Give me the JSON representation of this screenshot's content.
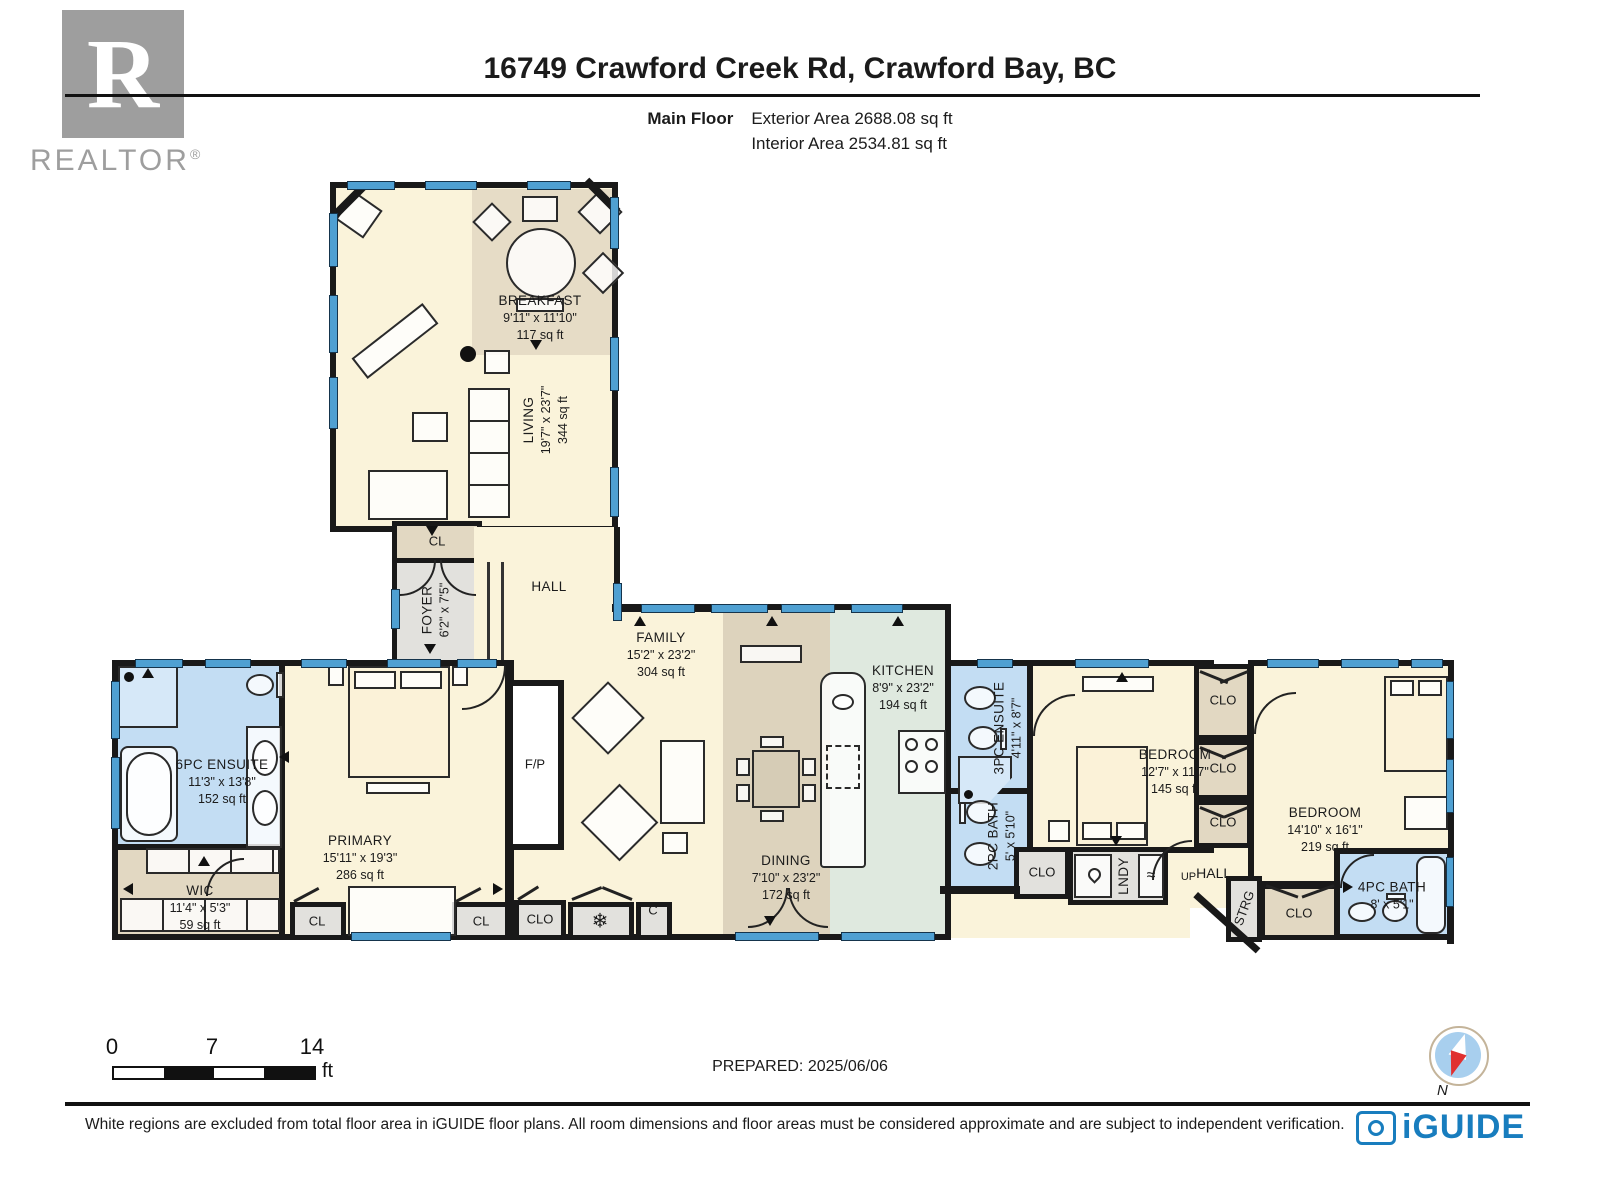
{
  "header": {
    "logo_r": "R",
    "realtor": "REALTOR",
    "registered": "®",
    "title": "16749 Crawford Creek Rd, Crawford Bay, BC",
    "floor_label": "Main Floor",
    "exterior_area": "Exterior Area 2688.08 sq ft",
    "interior_area": "Interior Area 2534.81 sq ft"
  },
  "rooms": {
    "breakfast": {
      "name": "BREAKFAST",
      "dims": "9'11\" x 11'10\"",
      "area": "117 sq ft"
    },
    "living": {
      "name": "LIVING",
      "dims": "19'7\" x 23'7\"",
      "area": "344 sq ft"
    },
    "foyer": {
      "name": "FOYER",
      "dims": "6'2\" x 7'5\""
    },
    "hall": {
      "name": "HALL"
    },
    "family": {
      "name": "FAMILY",
      "dims": "15'2\" x 23'2\"",
      "area": "304 sq ft"
    },
    "kitchen": {
      "name": "KITCHEN",
      "dims": "8'9\" x 23'2\"",
      "area": "194 sq ft"
    },
    "ensuite6": {
      "name": "6PC ENSUITE",
      "dims": "11'3\" x 13'8\"",
      "area": "152 sq ft"
    },
    "wic": {
      "name": "WIC",
      "dims": "11'4\" x 5'3\"",
      "area": "59 sq ft"
    },
    "primary": {
      "name": "PRIMARY",
      "dims": "15'11\" x 19'3\"",
      "area": "286 sq ft"
    },
    "dining": {
      "name": "DINING",
      "dims": "7'10\" x 23'2\"",
      "area": "172 sq ft"
    },
    "ensuite3": {
      "name": "3PC ENSUITE",
      "dims": "4'11\" x 8'7\""
    },
    "bath2": {
      "name": "2PC BATH",
      "dims": "5' x 5'10\""
    },
    "bedroom1": {
      "name": "BEDROOM",
      "dims": "12'7\" x 11'7\"",
      "area": "145 sq ft"
    },
    "bedroom2": {
      "name": "BEDROOM",
      "dims": "14'10\" x 16'1\"",
      "area": "219 sq ft"
    },
    "bath4": {
      "name": "4PC BATH",
      "dims": "8' x 5'1\""
    }
  },
  "labels": {
    "cl": "CL",
    "clo": "CLO",
    "c": "C",
    "fp": "F/P",
    "lndy": "LNDY",
    "up": "UP",
    "hall": "HALL",
    "strg": "STRG",
    "north": "N"
  },
  "icons": {
    "freezer": "❄",
    "dryer": "≈"
  },
  "scalebar": {
    "n0": "0",
    "n7": "7",
    "n14": "14",
    "unit": "ft"
  },
  "footer": {
    "prepared": "PREPARED: 2025/06/06",
    "disclaimer": "White regions are excluded from total floor area in iGUIDE floor plans. All room dimensions and floor areas must be considered approximate and are subject to independent verification.",
    "brand": "iGUIDE"
  },
  "colors": {
    "cream": "#FAF3DA",
    "tan": "#E2D8C2",
    "bath_blue": "#C3DDF3",
    "mint": "#DFE9DF",
    "gray": "#E2E1DD",
    "window": "#4FA0D2",
    "wall": "#191919",
    "brand_blue": "#187DBE",
    "compass_red": "#E03030",
    "logo_gray": "#9E9E9E"
  }
}
